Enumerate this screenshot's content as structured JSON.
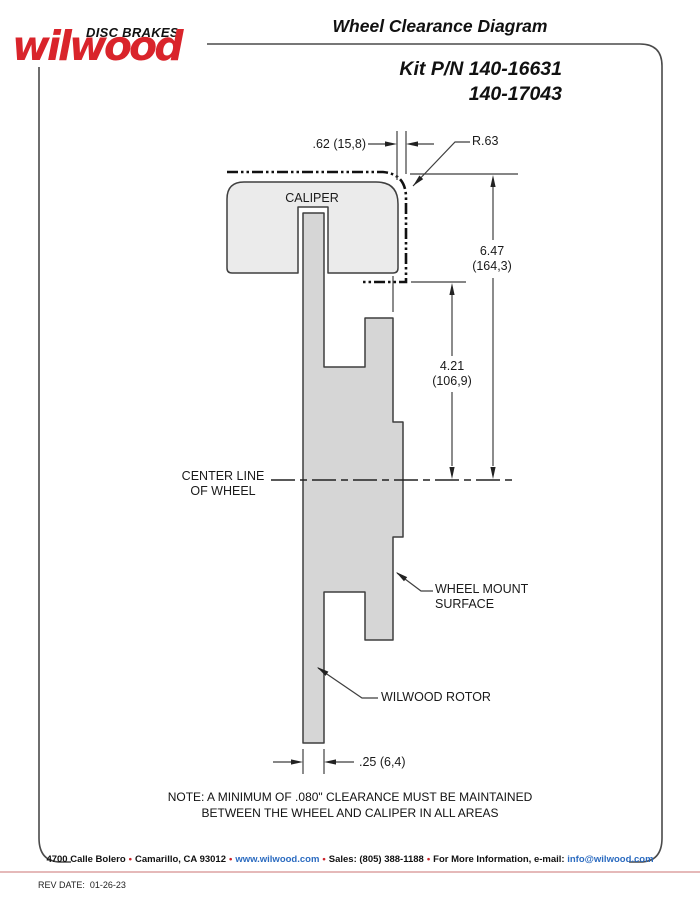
{
  "logo": {
    "brand": "wilwood",
    "tagline": "DISC BRAKES"
  },
  "header": {
    "title": "Wheel Clearance Diagram",
    "kit_line1": "Kit P/N 140-16631",
    "kit_line2": "140-17043"
  },
  "diagram": {
    "caliper_label": "CALIPER",
    "dims": {
      "caliper_wheel_gap": ".62 (15,8)",
      "corner_radius": "R.63",
      "caliper_top_to_cl_in": "6.47",
      "caliper_top_to_cl_mm": "(164,3)",
      "mount_to_cl_in": "4.21",
      "mount_to_cl_mm": "(106,9)",
      "rotor_thickness": ".25 (6,4)"
    },
    "labels": {
      "centerline_1": "CENTER LINE",
      "centerline_2": "OF WHEEL",
      "wheel_mount_1": "WHEEL MOUNT",
      "wheel_mount_2": "SURFACE",
      "rotor": "WILWOOD ROTOR"
    }
  },
  "note": {
    "line1": "NOTE: A MINIMUM OF .080\" CLEARANCE MUST BE MAINTAINED",
    "line2": "BETWEEN THE WHEEL AND CALIPER IN ALL AREAS"
  },
  "footer": {
    "address": "4700 Calle Bolero",
    "city": "Camarillo, CA 93012",
    "url": "www.wilwood.com",
    "sales": "Sales: (805) 388-1188",
    "more_info": "For More Information, e-mail:",
    "email": "info@wilwood.com",
    "separator": "•",
    "rev_date": "REV DATE:  01-26-23"
  },
  "colors": {
    "brand_red": "#d9242b",
    "link_blue": "#2b6bc0"
  }
}
